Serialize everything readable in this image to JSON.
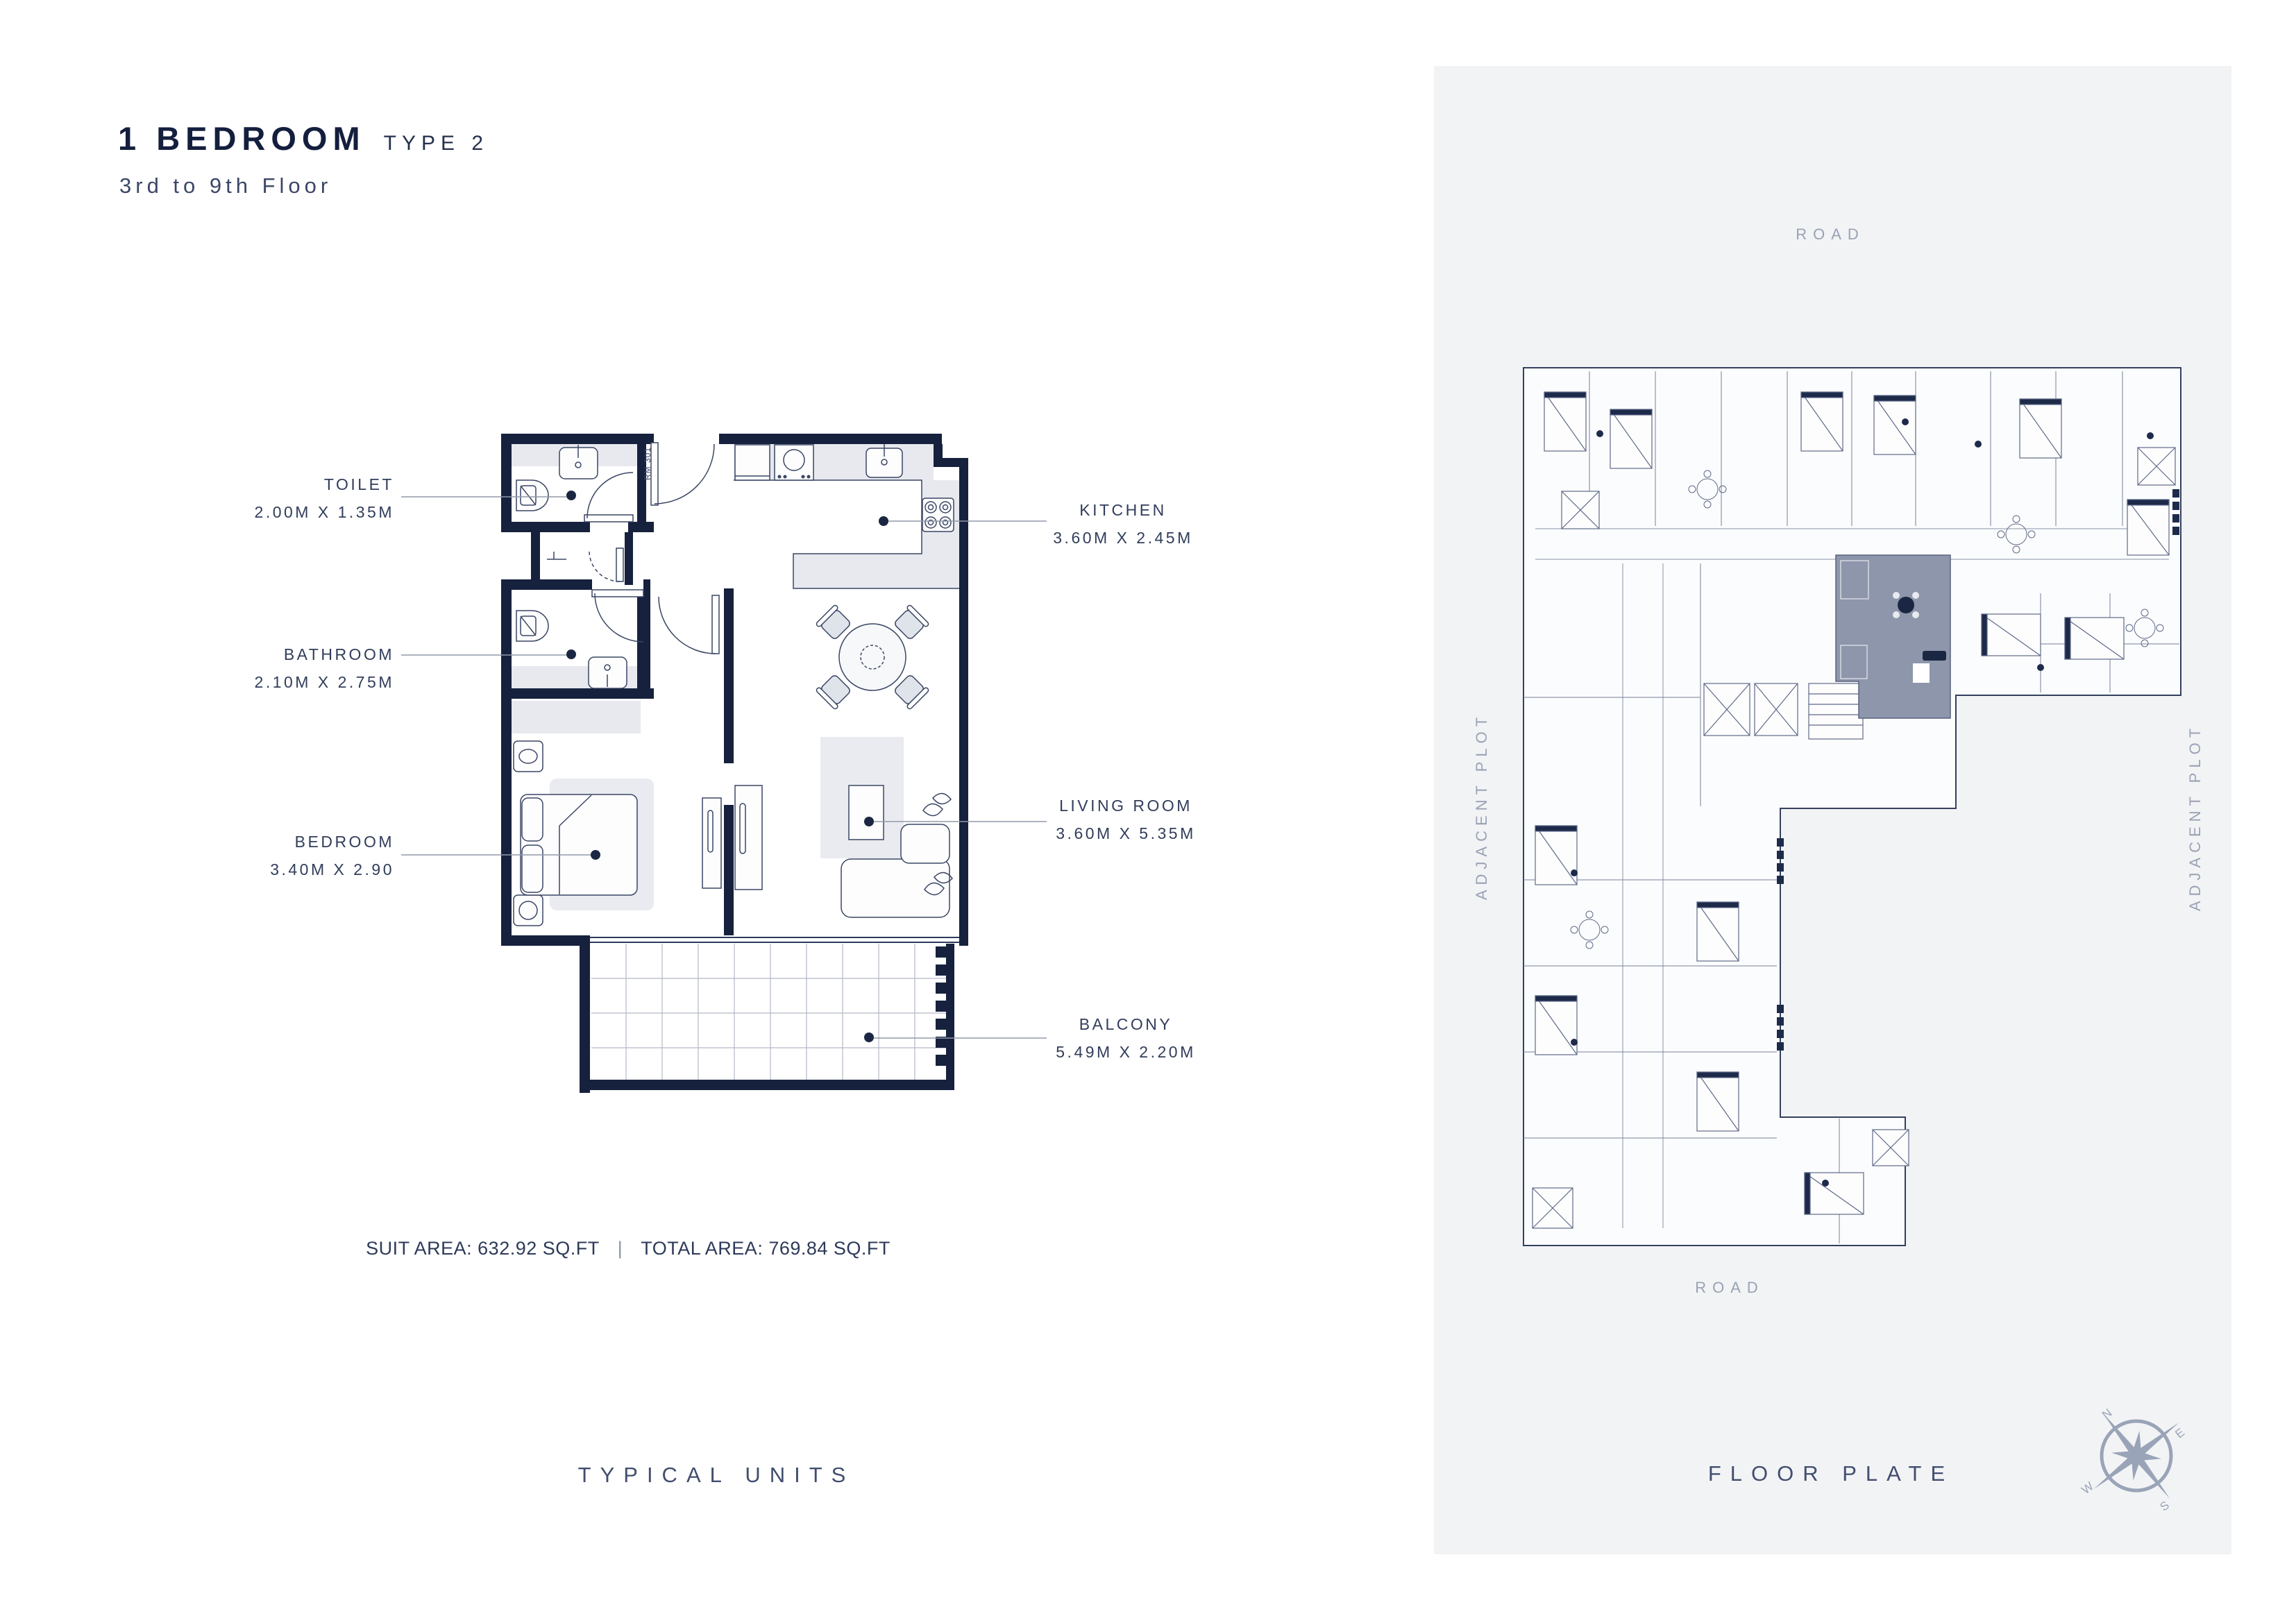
{
  "header": {
    "title": "1 BEDROOM",
    "type": "TYPE 2",
    "floors": "3rd to 9th Floor"
  },
  "unit_plan": {
    "room_id": "RM 301",
    "labels": [
      {
        "id": "toilet",
        "name": "TOILET",
        "dims": "2.00M X 1.35M"
      },
      {
        "id": "bathroom",
        "name": "BATHROOM",
        "dims": "2.10M X 2.75M"
      },
      {
        "id": "bedroom",
        "name": "BEDROOM",
        "dims": "3.40M X 2.90"
      },
      {
        "id": "kitchen",
        "name": "KITCHEN",
        "dims": "3.60M X 2.45M"
      },
      {
        "id": "living_room",
        "name": "LIVING ROOM",
        "dims": "3.60M X 5.35M"
      },
      {
        "id": "balcony",
        "name": "BALCONY",
        "dims": "5.49M X 2.20M"
      }
    ],
    "areas": {
      "suit": "SUIT AREA: 632.92 SQ.FT",
      "divider": "|",
      "total": "TOTAL AREA: 769.84 SQ.FT"
    },
    "caption": "TYPICAL UNITS"
  },
  "floor_plate": {
    "caption": "FLOOR PLATE",
    "road_top": "ROAD",
    "road_bottom": "ROAD",
    "adjacent_left": "ADJACENT PLOT",
    "adjacent_right": "ADJACENT PLOT",
    "compass": {
      "n": "N",
      "e": "E",
      "s": "S",
      "w": "W"
    }
  },
  "colors": {
    "wall_navy": "#16213d",
    "panel_gray": "#f2f3f5",
    "highlight_unit": "#8d96aa",
    "muted_text": "#99a2b4",
    "label_text": "#313d5b",
    "leader_line": "#9299a8",
    "furniture_fill": "#e7e9ef"
  }
}
